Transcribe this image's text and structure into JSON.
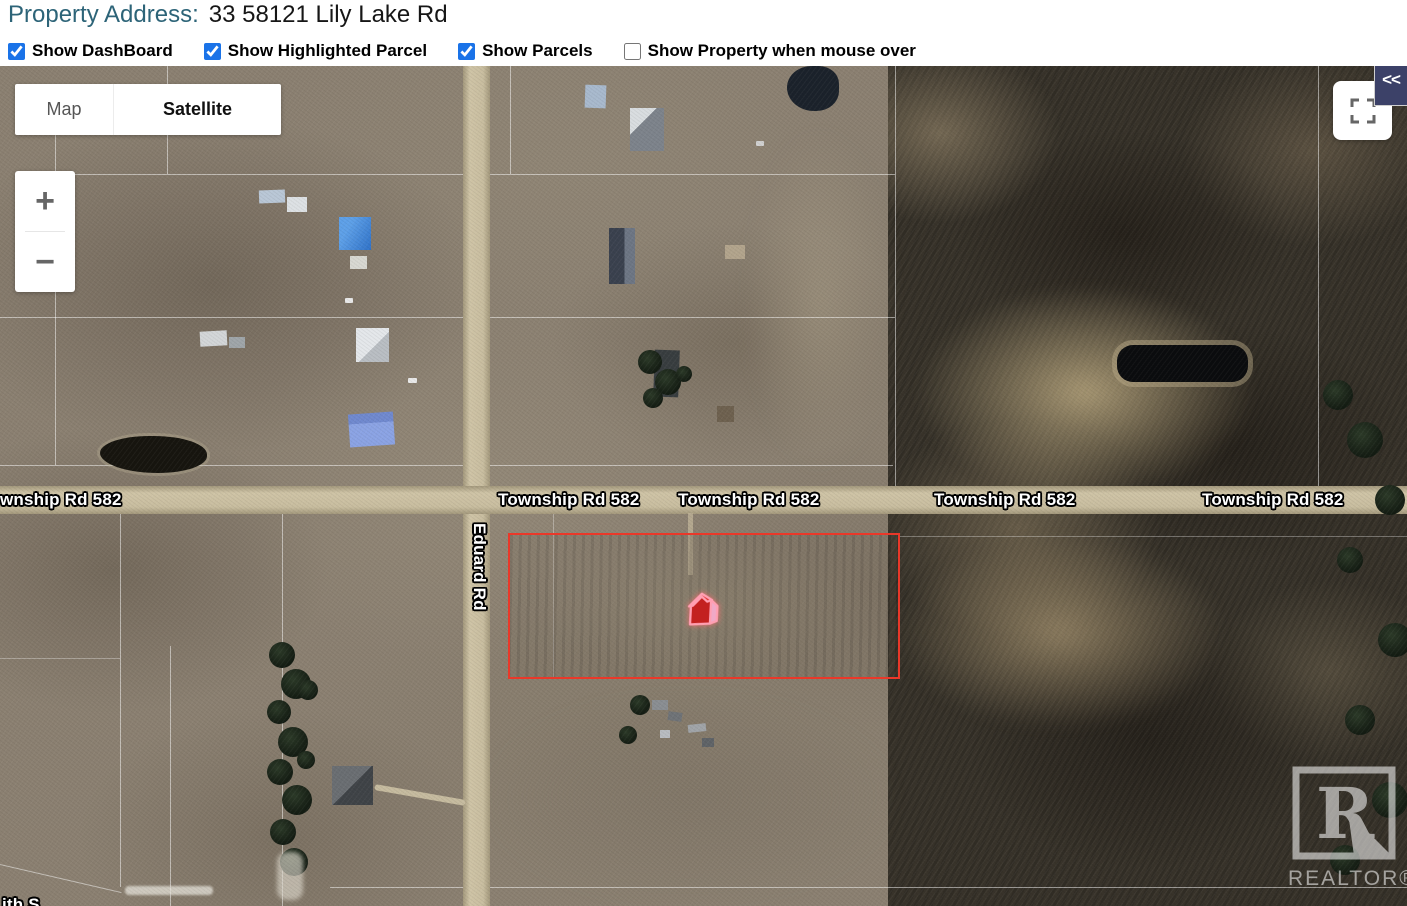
{
  "header": {
    "property_label": "Property Address:",
    "property_value": "33 58121 Lily Lake Rd",
    "checkboxes": [
      {
        "label": "Show DashBoard",
        "checked": true
      },
      {
        "label": "Show Highlighted Parcel",
        "checked": true
      },
      {
        "label": "Show Parcels",
        "checked": true
      },
      {
        "label": "Show Property when mouse over",
        "checked": false
      }
    ]
  },
  "map": {
    "type_control": {
      "map_label": "Map",
      "satellite_label": "Satellite",
      "selected": "Satellite"
    },
    "zoom_control": {
      "zoom_in": "+",
      "zoom_out": "−"
    },
    "collapse_button": "<<",
    "road_labels": {
      "township": "Township Rd 582",
      "township_partial": "wnship Rd 582",
      "eduard": "Eduard Rd",
      "bottom_partial": "ith S"
    },
    "highlighted_parcel": {
      "marker": "house-3d",
      "outline_color": "#ea3829"
    },
    "watermark": {
      "logo": "R",
      "text": "REALTOR®"
    },
    "colors": {
      "checkbox_blue": "#1a73e8",
      "header_teal": "#2d6478",
      "collapse_navy": "#3c4168",
      "parcel_red": "#ea3829"
    }
  }
}
